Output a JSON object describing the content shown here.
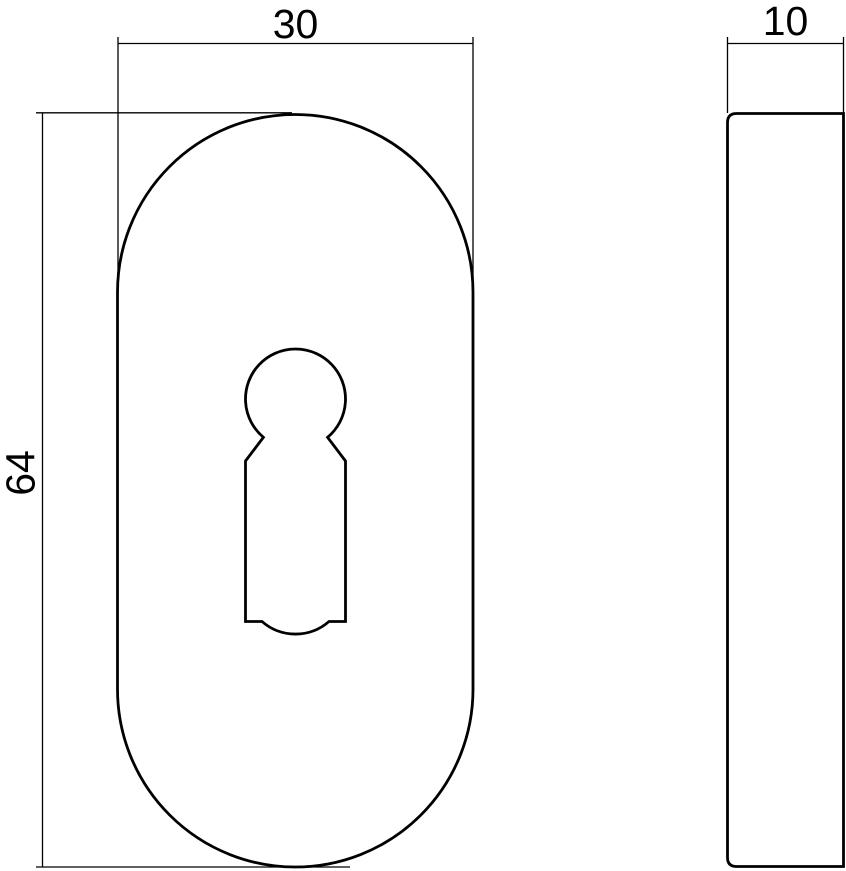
{
  "drawing": {
    "front_view": {
      "width_label": "30",
      "height_label": "64"
    },
    "side_view": {
      "thickness_label": "10"
    }
  },
  "colors": {
    "line": "#000000",
    "background": "#ffffff"
  }
}
